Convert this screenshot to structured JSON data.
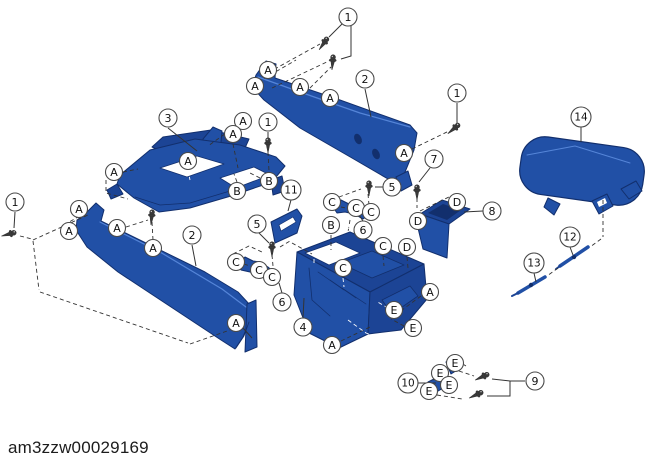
{
  "diagram": {
    "watermark": "am3zzw00029169",
    "canvas": {
      "width": 655,
      "height": 468
    },
    "colors": {
      "background": "#ffffff",
      "part_fill": "#2150a6",
      "part_mid": "#1c4495",
      "part_dark": "#122f6d",
      "part_light": "#5585d8",
      "white": "#ffffff",
      "line": "#333333",
      "callout_border": "#4a4a4a",
      "callout_fill": "#ffffff",
      "callout_text": "#111111",
      "screw_fill": "#3a3a3a",
      "screw_highlight": "#cfcfcf"
    },
    "callouts": [
      {
        "t": "1",
        "x": 348,
        "y": 17
      },
      {
        "t": "1",
        "x": 268,
        "y": 122
      },
      {
        "t": "1",
        "x": 457,
        "y": 93
      },
      {
        "t": "1",
        "x": 15,
        "y": 202
      },
      {
        "t": "2",
        "x": 365,
        "y": 79
      },
      {
        "t": "2",
        "x": 192,
        "y": 235
      },
      {
        "t": "3",
        "x": 168,
        "y": 118
      },
      {
        "t": "4",
        "x": 303,
        "y": 327
      },
      {
        "t": "5",
        "x": 392,
        "y": 187
      },
      {
        "t": "5",
        "x": 257,
        "y": 224
      },
      {
        "t": "6",
        "x": 363,
        "y": 230
      },
      {
        "t": "6",
        "x": 282,
        "y": 302
      },
      {
        "t": "7",
        "x": 434,
        "y": 159
      },
      {
        "t": "8",
        "x": 492,
        "y": 211
      },
      {
        "t": "9",
        "x": 535,
        "y": 381
      },
      {
        "t": "10",
        "x": 408,
        "y": 383
      },
      {
        "t": "11",
        "x": 291,
        "y": 190
      },
      {
        "t": "12",
        "x": 570,
        "y": 237
      },
      {
        "t": "13",
        "x": 534,
        "y": 263
      },
      {
        "t": "14",
        "x": 581,
        "y": 117
      },
      {
        "t": "A",
        "x": 268,
        "y": 70
      },
      {
        "t": "A",
        "x": 255,
        "y": 86
      },
      {
        "t": "A",
        "x": 300,
        "y": 87
      },
      {
        "t": "A",
        "x": 330,
        "y": 98
      },
      {
        "t": "A",
        "x": 404,
        "y": 153
      },
      {
        "t": "A",
        "x": 243,
        "y": 121
      },
      {
        "t": "A",
        "x": 233,
        "y": 134
      },
      {
        "t": "A",
        "x": 114,
        "y": 172
      },
      {
        "t": "A",
        "x": 188,
        "y": 161
      },
      {
        "t": "A",
        "x": 79,
        "y": 209
      },
      {
        "t": "A",
        "x": 69,
        "y": 231
      },
      {
        "t": "A",
        "x": 117,
        "y": 228
      },
      {
        "t": "A",
        "x": 153,
        "y": 248
      },
      {
        "t": "A",
        "x": 236,
        "y": 323
      },
      {
        "t": "A",
        "x": 430,
        "y": 292
      },
      {
        "t": "A",
        "x": 332,
        "y": 345
      },
      {
        "t": "B",
        "x": 269,
        "y": 181
      },
      {
        "t": "B",
        "x": 237,
        "y": 191
      },
      {
        "t": "B",
        "x": 331,
        "y": 225
      },
      {
        "t": "C",
        "x": 332,
        "y": 202
      },
      {
        "t": "C",
        "x": 356,
        "y": 208
      },
      {
        "t": "C",
        "x": 371,
        "y": 212
      },
      {
        "t": "C",
        "x": 236,
        "y": 262
      },
      {
        "t": "C",
        "x": 259,
        "y": 270
      },
      {
        "t": "C",
        "x": 272,
        "y": 277
      },
      {
        "t": "C",
        "x": 383,
        "y": 246
      },
      {
        "t": "C",
        "x": 343,
        "y": 268
      },
      {
        "t": "D",
        "x": 457,
        "y": 202
      },
      {
        "t": "D",
        "x": 418,
        "y": 221
      },
      {
        "t": "D",
        "x": 407,
        "y": 247
      },
      {
        "t": "E",
        "x": 394,
        "y": 310
      },
      {
        "t": "E",
        "x": 413,
        "y": 328
      },
      {
        "t": "E",
        "x": 455,
        "y": 363
      },
      {
        "t": "E",
        "x": 440,
        "y": 373
      },
      {
        "t": "E",
        "x": 449,
        "y": 385
      },
      {
        "t": "E",
        "x": 429,
        "y": 391
      }
    ],
    "leader_lines": [
      "342,24 329,37",
      "351,26 351,56 341,59",
      "365,89 371,117",
      "457,103 457,124",
      "168,128 197,151",
      "268,132 268,139",
      "581,127 581,142",
      "430,168 419,182",
      "483,211 464,212",
      "383,187 375,187",
      "259,233 269,243",
      "291,200 288,211",
      "363,221 359,215",
      "282,293 279,283",
      "303,318 304,298",
      "192,245 196,266",
      "15,212 14,228",
      "418,383 436,383",
      "525,381 510,381",
      "510,381 492,379",
      "510,381 510,396 487,396",
      "570,247 573,255",
      "534,273 536,282",
      "243,328 252,338"
    ],
    "dashed_lines": [
      {
        "p": "262,76 320,44"
      },
      {
        "p": "272,88 331,60"
      },
      {
        "p": "305,93 331,67"
      },
      {
        "p": "258,82 296,60"
      },
      {
        "p": "412,149 449,131"
      },
      {
        "p": "236,126 208,146"
      },
      {
        "p": "233,144 238,168"
      },
      {
        "p": "268,152 269,171"
      },
      {
        "p": "123,172 138,169"
      },
      {
        "p": "106,180 106,193 128,199"
      },
      {
        "p": "188,170 190,180",
        "w": 1
      },
      {
        "p": "260,178 248,172"
      },
      {
        "p": "237,182 234,174"
      },
      {
        "p": "20,236 32,239"
      },
      {
        "p": "33,240 88,215"
      },
      {
        "p": "33,241 39,290"
      },
      {
        "p": "40,292 188,343"
      },
      {
        "p": "190,344 230,330"
      },
      {
        "p": "64,225 78,217"
      },
      {
        "p": "126,227 148,220"
      },
      {
        "p": "152,222 153,240"
      },
      {
        "p": "244,264 253,267"
      },
      {
        "p": "263,272 266,274"
      },
      {
        "p": "272,255 273,266"
      },
      {
        "p": "280,247 290,241"
      },
      {
        "p": "292,243 312,254"
      },
      {
        "p": "233,254 249,246 262,252"
      },
      {
        "p": "339,197 361,189"
      },
      {
        "p": "368,194 369,205"
      },
      {
        "p": "341,207 350,209"
      },
      {
        "p": "350,220 348,232"
      },
      {
        "p": "331,235 331,250"
      },
      {
        "p": "383,256 384,266"
      },
      {
        "p": "407,257 408,268"
      },
      {
        "p": "343,278 344,287",
        "w": 1
      },
      {
        "p": "307,243 352,227",
        "w": 1
      },
      {
        "p": "352,227 404,250",
        "w": 1
      },
      {
        "p": "314,252 314,264",
        "w": 1
      },
      {
        "p": "420,211 451,196"
      },
      {
        "p": "417,198 417,208"
      },
      {
        "p": "421,296 402,310"
      },
      {
        "p": "388,308 376,301",
        "w": 1
      },
      {
        "p": "404,326 391,319"
      },
      {
        "p": "341,341 370,327"
      },
      {
        "p": "348,320 366,333 392,342",
        "w": 1
      },
      {
        "p": "452,357 466,366"
      },
      {
        "p": "459,371 474,376"
      },
      {
        "p": "437,395 462,399"
      },
      {
        "p": "433,380 442,371"
      },
      {
        "p": "603,200 603,237"
      },
      {
        "p": "601,239 590,247"
      },
      {
        "p": "558,268 547,276"
      }
    ],
    "screws": [
      {
        "x": 326,
        "y": 40,
        "angle": 35
      },
      {
        "x": 333,
        "y": 58,
        "angle": 5
      },
      {
        "x": 268,
        "y": 141,
        "angle": 0
      },
      {
        "x": 457,
        "y": 126,
        "angle": 50
      },
      {
        "x": 13,
        "y": 233,
        "angle": 75
      },
      {
        "x": 152,
        "y": 213,
        "angle": 5
      },
      {
        "x": 272,
        "y": 245,
        "angle": 0
      },
      {
        "x": 369,
        "y": 184,
        "angle": 0
      },
      {
        "x": 417,
        "y": 188,
        "angle": 0
      },
      {
        "x": 486,
        "y": 375,
        "angle": 65
      },
      {
        "x": 480,
        "y": 393,
        "angle": 65
      }
    ],
    "parts": [
      {
        "name": "side-panel-upper",
        "shapes": [
          {
            "type": "polygon",
            "points": "256,75 266,61 276,64 275,78 340,100 410,125 417,133 414,150 403,177 395,183 352,158 300,128 264,100 252,87",
            "fill": "part_fill",
            "stroke": "part_dark",
            "sw": 1
          },
          {
            "type": "polyline",
            "points": "258,77 300,92 360,113 410,127",
            "stroke": "part_light",
            "sw": 1.2
          },
          {
            "type": "ellipse",
            "cx": 358,
            "cy": 139,
            "rx": 3.5,
            "ry": 5.5,
            "rot": -25,
            "fill": "part_dark"
          },
          {
            "type": "ellipse",
            "cx": 376,
            "cy": 154,
            "rx": 3.5,
            "ry": 5.5,
            "rot": -25,
            "fill": "part_dark"
          },
          {
            "type": "polygon",
            "points": "396,177 408,171 412,185 401,191",
            "fill": "part_fill",
            "stroke": "part_dark",
            "sw": 1
          }
        ]
      },
      {
        "name": "frame",
        "shapes": [
          {
            "type": "polygon",
            "points": "152,147 163,137 211,130 249,139 245,148 199,141 163,152",
            "fill": "part_mid",
            "stroke": "part_dark",
            "sw": 1
          },
          {
            "type": "polygon",
            "points": "203,139 213,127 222,131 219,165 206,168",
            "fill": "part_fill",
            "stroke": "part_dark",
            "sw": 1
          },
          {
            "type": "polygon",
            "points": "120,175 150,150 195,139 240,145 276,157 285,166 272,182 231,196 190,208 159,212 134,198 117,184",
            "fill": "part_fill",
            "stroke": "part_dark",
            "sw": 1
          },
          {
            "type": "polygon",
            "points": "160,168 197,156 224,164 187,177",
            "fill": "white",
            "stroke": "part_dark",
            "sw": 0.8
          },
          {
            "type": "polygon",
            "points": "220,178 254,167 270,175 236,188",
            "fill": "white",
            "stroke": "part_dark",
            "sw": 0.8
          },
          {
            "type": "polygon",
            "points": "117,184 107,190 111,199 123,194",
            "fill": "part_mid",
            "stroke": "part_dark",
            "sw": 1
          },
          {
            "type": "polygon",
            "points": "271,180 282,176 285,191 273,195",
            "fill": "part_mid",
            "stroke": "part_dark",
            "sw": 1
          },
          {
            "type": "polyline",
            "points": "135,197 160,205 190,203 230,191",
            "stroke": "part_dark",
            "sw": 0.8
          }
        ]
      },
      {
        "name": "side-panel-lower",
        "shapes": [
          {
            "type": "polygon",
            "points": "85,214 96,203 104,210 101,221 150,245 205,272 238,292 250,305 249,322 243,337 235,349 221,340 168,305 118,272 87,247 76,230 77,220",
            "fill": "part_fill",
            "stroke": "part_dark",
            "sw": 1
          },
          {
            "type": "polyline",
            "points": "100,222 160,252 222,289 246,307",
            "stroke": "part_light",
            "sw": 1.2
          },
          {
            "type": "polygon",
            "points": "247,304 256,300 257,347 245,352",
            "fill": "part_fill",
            "stroke": "part_dark",
            "sw": 1
          },
          {
            "type": "polyline",
            "points": "236,348 244,336 249,322",
            "stroke": "part_dark",
            "sw": 0.8
          }
        ]
      },
      {
        "name": "console-body",
        "shapes": [
          {
            "type": "polygon",
            "points": "297,252 350,232 424,264 370,292",
            "fill": "part_mid",
            "stroke": "part_dark",
            "sw": 1
          },
          {
            "type": "polygon",
            "points": "305,253 336,242 360,253 329,265",
            "fill": "white",
            "stroke": "part_dark",
            "sw": 0.8
          },
          {
            "type": "polygon",
            "points": "340,263 372,251 404,265 372,278",
            "fill": "part_fill",
            "stroke": "part_dark",
            "sw": 0.8
          },
          {
            "type": "polygon",
            "points": "297,252 370,292 368,334 339,348 309,333 294,295",
            "fill": "part_fill",
            "stroke": "part_dark",
            "sw": 1
          },
          {
            "type": "polygon",
            "points": "370,292 424,264 427,299 401,330 368,334",
            "fill": "part_mid",
            "stroke": "part_dark",
            "sw": 1
          },
          {
            "type": "polyline",
            "points": "309,268 312,300 330,316",
            "stroke": "part_dark",
            "sw": 0.8
          },
          {
            "type": "polyline",
            "points": "318,272 344,290",
            "stroke": "part_dark",
            "sw": 0.7
          },
          {
            "type": "polyline",
            "points": "330,280 356,298",
            "stroke": "part_dark",
            "sw": 0.7
          },
          {
            "type": "polyline",
            "points": "342,288 366,304",
            "stroke": "part_dark",
            "sw": 0.7
          },
          {
            "type": "polygon",
            "points": "382,300 410,286 418,296 392,314",
            "fill": "part_fill",
            "stroke": "part_dark",
            "sw": 0.8
          }
        ]
      },
      {
        "name": "pocket-box",
        "shapes": [
          {
            "type": "polygon",
            "points": "420,214 442,200 470,209 449,224",
            "fill": "part_mid",
            "stroke": "part_dark",
            "sw": 1
          },
          {
            "type": "polygon",
            "points": "428,213 443,204 461,210 447,220",
            "fill": "part_dark"
          },
          {
            "type": "polygon",
            "points": "420,214 449,224 447,258 423,249 418,228",
            "fill": "part_fill",
            "stroke": "part_dark",
            "sw": 1
          }
        ]
      },
      {
        "name": "plate",
        "shapes": [
          {
            "type": "polygon",
            "points": "271,222 297,209 302,216 297,233 275,243",
            "fill": "part_fill",
            "stroke": "part_dark",
            "sw": 1
          },
          {
            "type": "polygon",
            "points": "279,225 293,217 296,222 281,231",
            "fill": "white",
            "stroke": "part_dark",
            "sw": 0.7
          }
        ]
      },
      {
        "name": "bracket-right",
        "shapes": [
          {
            "type": "polygon",
            "points": "333,207 341,200 349,204 356,204 364,208 371,214 363,219 354,214 345,212 337,213",
            "fill": "part_fill",
            "stroke": "part_dark",
            "sw": 1
          }
        ]
      },
      {
        "name": "bracket-left",
        "shapes": [
          {
            "type": "polygon",
            "points": "237,264 245,257 253,261 260,262 268,267 276,274 268,280 259,275 250,272 241,270",
            "fill": "part_fill",
            "stroke": "part_dark",
            "sw": 1
          }
        ]
      },
      {
        "name": "armrest-lid",
        "shapes": [
          {
            "type": "rect",
            "x": 520,
            "y": 142,
            "w": 124,
            "h": 58,
            "rx": 24,
            "rot": "8 582 171",
            "fill": "part_fill",
            "stroke": "part_dark",
            "sw": 1.2
          },
          {
            "type": "polyline",
            "points": "527,155 575,146 630,163",
            "stroke": "part_light",
            "sw": 1
          },
          {
            "type": "polygon",
            "points": "548,198 560,204 554,215 544,207",
            "fill": "part_fill",
            "stroke": "part_dark",
            "sw": 1
          },
          {
            "type": "polygon",
            "points": "592,201 607,194 613,206 599,214",
            "fill": "part_fill",
            "stroke": "part_dark",
            "sw": 1
          },
          {
            "type": "polygon",
            "points": "597,202 605,198 607,203 599,207",
            "fill": "white"
          },
          {
            "type": "polygon",
            "points": "621,189 636,181 642,191 629,199",
            "fill": "part_fill",
            "stroke": "part_dark",
            "sw": 1
          }
        ]
      },
      {
        "name": "rod-long",
        "shapes": [
          {
            "type": "polyline",
            "points": "560,266 588,247",
            "stroke": "part_fill",
            "sw": 3.5
          },
          {
            "type": "ellipse",
            "cx": 574,
            "cy": 257,
            "rx": 2.2,
            "ry": 2.2,
            "fill": "part_dark"
          },
          {
            "type": "polyline",
            "points": "556,269 560,266",
            "stroke": "part_mid",
            "sw": 2
          }
        ]
      },
      {
        "name": "rod-short",
        "shapes": [
          {
            "type": "polyline",
            "points": "518,293 545,277",
            "stroke": "part_fill",
            "sw": 3.5
          },
          {
            "type": "ellipse",
            "cx": 531,
            "cy": 285,
            "rx": 2.2,
            "ry": 2.2,
            "fill": "part_dark"
          },
          {
            "type": "polyline",
            "points": "512,296 518,293",
            "stroke": "part_mid",
            "sw": 2
          }
        ]
      },
      {
        "name": "clips",
        "shapes": [
          {
            "type": "polygon",
            "points": "446,362 457,356 462,367 451,374",
            "fill": "part_fill",
            "stroke": "part_dark",
            "sw": 1
          },
          {
            "type": "polygon",
            "points": "428,382 440,376 445,387 433,394",
            "fill": "part_fill",
            "stroke": "part_dark",
            "sw": 1
          }
        ]
      }
    ]
  }
}
